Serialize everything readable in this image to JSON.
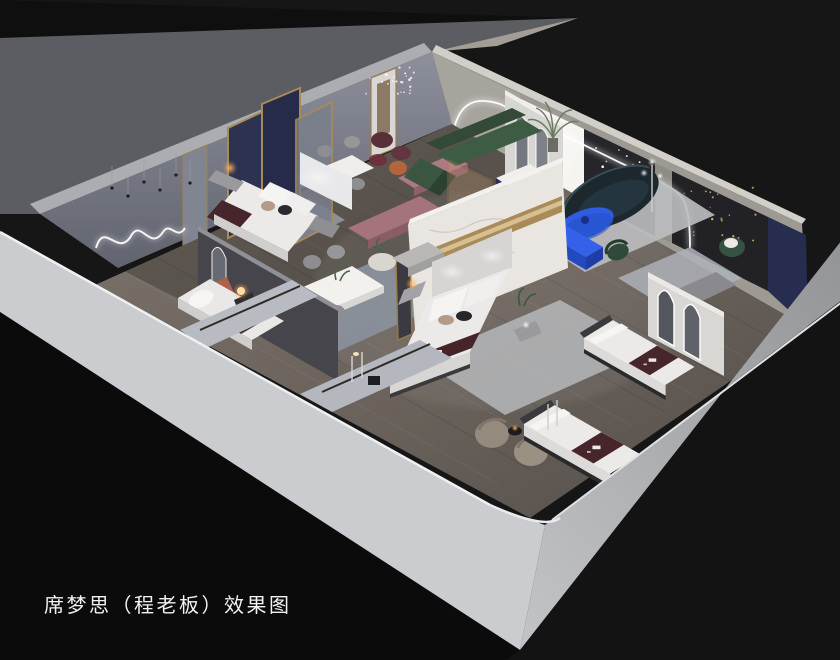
{
  "caption": {
    "text": "席梦思（程老板）效果图"
  },
  "scene": {
    "type": "isometric-interior-rendering",
    "subject": "mattress showroom cutaway floor view",
    "objects": [
      "display-bed",
      "mattress-display",
      "dining-table",
      "green-sofa",
      "navy-curved-sofa",
      "blue-coffee-table",
      "blue-tv-console",
      "gold-screen-partition",
      "marble-partition",
      "arch-mirror",
      "wicker-chair",
      "mauve-bench",
      "neon-squiggle-art",
      "chandelier",
      "string-lights",
      "palm-plant",
      "orb-lamp"
    ]
  },
  "colors": {
    "bg": "#161617",
    "bg_dark": "#0b0b0c",
    "outer_band": "#5b5d62",
    "wall_edge": "#abadb1",
    "sw_wall": "#cbccd0",
    "se_wall": "#b7b8bc",
    "nw_wall": "#8a8e9a",
    "ne_wall": "#9d9a94",
    "floor": "#6e665f",
    "floor_dark": "#4f4a45",
    "marble": "#e9e6e1",
    "gold": "#a98a58",
    "navy_panel": "#262d4f",
    "charcoal": "#26262a",
    "green_sofa": "#3e5b44",
    "green_chair": "#2f4a38",
    "navy_sofa": "#1c272e",
    "cobalt": "#2f5ce0",
    "cobalt_dark": "#2348c0",
    "burgundy": "#47262b",
    "mauve": "#a4737c",
    "bed_white": "#eceae8",
    "rug_light": "#bdbec1",
    "rug_blue": "#8b929d",
    "wicker": "#948b7d",
    "warm_light": "#ffc377",
    "led_white": "#ffffff"
  }
}
